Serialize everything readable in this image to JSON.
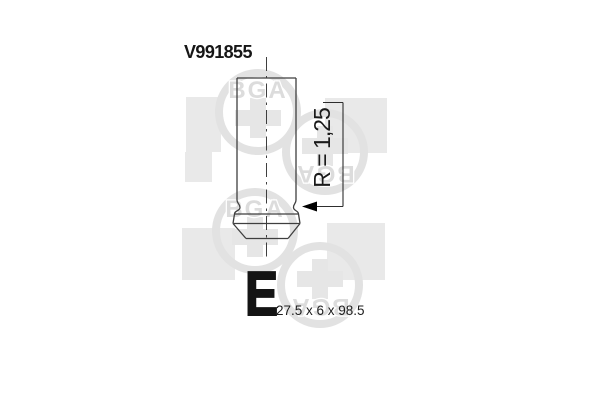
{
  "header": {
    "part_number": "V991855"
  },
  "drawing": {
    "radius_label": "R = 1,25"
  },
  "spec": {
    "type_letter": "E",
    "dimensions": "27.5 x 6 x 98.5"
  },
  "watermark": {
    "brand": "BGA"
  },
  "colors": {
    "background": "#ffffff",
    "line": "#3f3f3f",
    "text": "#161616",
    "watermark_gray": "#e4e4e4"
  }
}
